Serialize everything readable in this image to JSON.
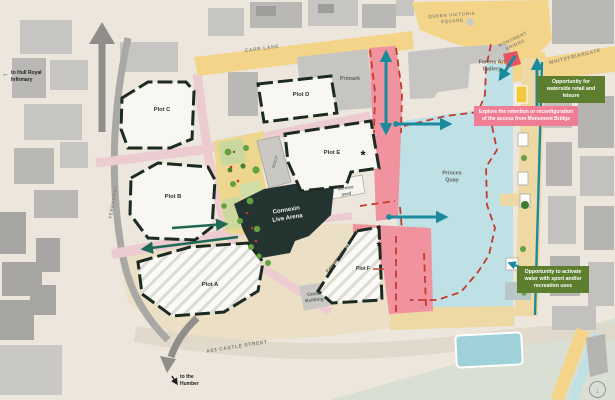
{
  "streets": {
    "carr_lane": "CARR LANE",
    "queen_victoria_square": "QUEEN VICTORIA SQUARE",
    "monument_bridge": "MONUMENT BRIDGE",
    "whitefriargate": "WHITEFRIARGATE",
    "ferensway": "FERENSWAY",
    "a63_castle_street": "A63 CASTLE STREET"
  },
  "places": {
    "primark": "Primark",
    "ferens_art_gallery": "Ferens Art Gallery",
    "princes_quay": "Princes Quay",
    "castle_building": "Castle Building",
    "service_yard": "Service yard",
    "consented_hotel": "Consented hotel",
    "mscp": "MSCP",
    "connexin_live_arena": "Connexin Live Arena"
  },
  "plots": {
    "plot_a": "Plot A",
    "plot_b": "Plot B",
    "plot_c": "Plot C",
    "plot_d": "Plot D",
    "plot_e": "Plot E",
    "plot_f": "Plot F"
  },
  "markers": {
    "asterisk_plot_e": "*",
    "asterisk_plot_f": "*"
  },
  "directions": {
    "hull_royal_infirmary": "to Hull Royal Infirmary",
    "humber": "to the Humber",
    "arrow_left": "←",
    "arrow_southeast": "↘"
  },
  "annotations": {
    "waterside_retail": "Opportunity for waterside retail and leisure",
    "monument_access": "Explore the retention or reconfiguration of the access from Monument Bridge",
    "activate_water": "Opportunity to activate water with sport and/or recreation uses"
  },
  "icons": {
    "download_arrow": "↓"
  },
  "colors": {
    "water": "#bfe1e5",
    "pink_zone": "#f0939f",
    "red_dash": "#c23b2e",
    "teal_arrow": "#1a8a9d",
    "green_arrow": "#1e6a55",
    "green_note": "#5c7e2e",
    "pink_note": "#ef7e95",
    "yellow_road": "#f3d488",
    "park": "#edd78f",
    "plot_outline": "#1c2b22"
  }
}
